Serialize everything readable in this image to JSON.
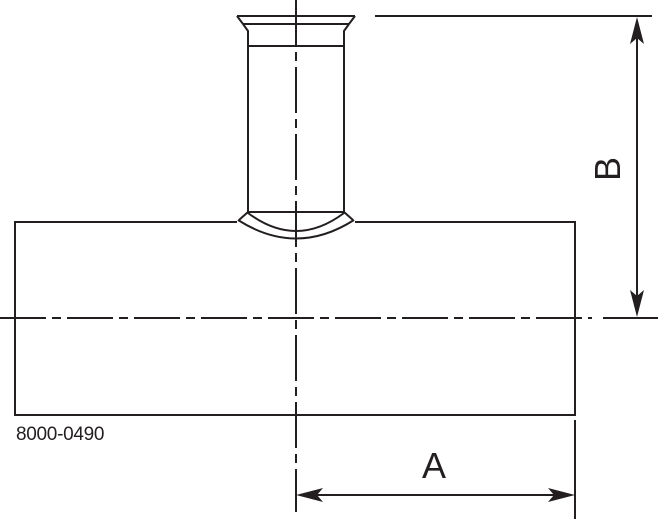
{
  "drawing": {
    "part_number": "8000-0490",
    "title": "reducing-tee-with-tri-clamp-branch",
    "dimensions": {
      "horizontal_label": "A",
      "vertical_label": "B"
    },
    "colors": {
      "line": "#231f20",
      "background": "#ffffff"
    }
  }
}
